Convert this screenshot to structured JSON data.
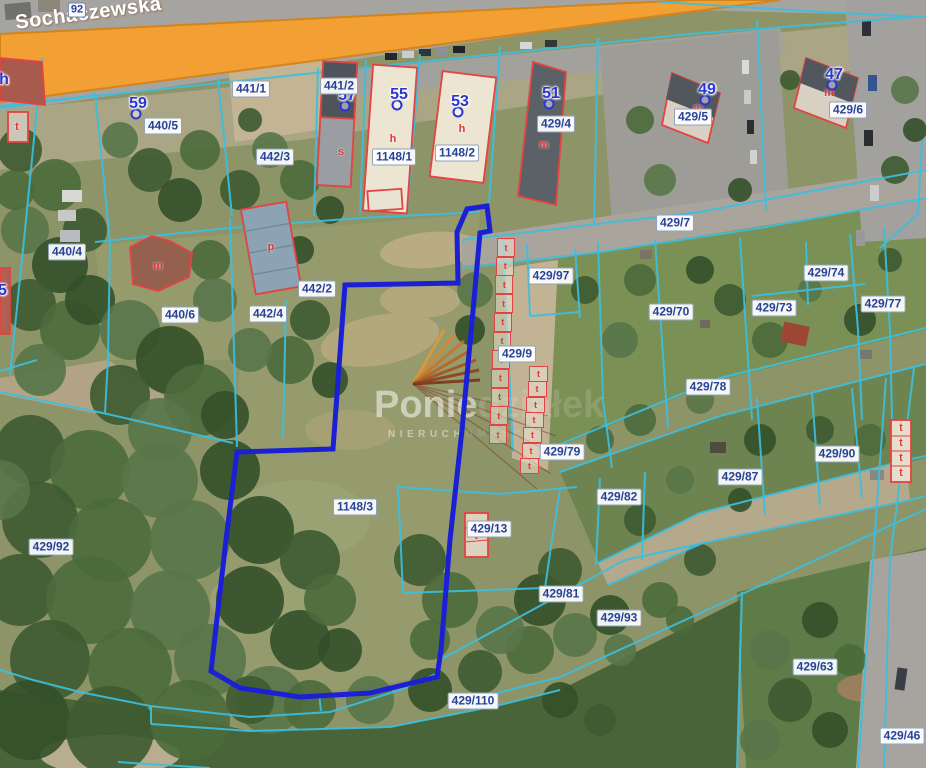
{
  "map": {
    "street": {
      "name": "Sochaczewska",
      "road_number": "92"
    },
    "watermark": {
      "brand_strong": "Ponie",
      "brand_faint": "działek",
      "subtitle_strong": "NIERUCH",
      "subtitle_faint": "OMOŚCI"
    },
    "colors": {
      "parcel_line": "#3dbfdf",
      "selected_parcel": "#1c20d4",
      "building_outline": "#e34343",
      "label_text": "#26429a",
      "house_number": "#2b36cf",
      "letter_red": "#e23535",
      "road_orange": "#f2a033",
      "road_border": "#d3841c"
    },
    "parcel_labels": [
      {
        "text": "440/5",
        "x": 163,
        "y": 126
      },
      {
        "text": "441/1",
        "x": 251,
        "y": 89
      },
      {
        "text": "441/2",
        "x": 339,
        "y": 86
      },
      {
        "text": "442/3",
        "x": 275,
        "y": 157
      },
      {
        "text": "1148/1",
        "x": 394,
        "y": 157
      },
      {
        "text": "1148/2",
        "x": 457,
        "y": 153
      },
      {
        "text": "429/4",
        "x": 556,
        "y": 124
      },
      {
        "text": "429/5",
        "x": 693,
        "y": 117
      },
      {
        "text": "429/6",
        "x": 848,
        "y": 110
      },
      {
        "text": "429/7",
        "x": 675,
        "y": 223
      },
      {
        "text": "440/4",
        "x": 67,
        "y": 252
      },
      {
        "text": "442/2",
        "x": 317,
        "y": 289
      },
      {
        "text": "440/6",
        "x": 180,
        "y": 315
      },
      {
        "text": "442/4",
        "x": 268,
        "y": 314
      },
      {
        "text": "429/97",
        "x": 551,
        "y": 276
      },
      {
        "text": "429/70",
        "x": 671,
        "y": 312
      },
      {
        "text": "429/74",
        "x": 826,
        "y": 273
      },
      {
        "text": "429/73",
        "x": 774,
        "y": 308
      },
      {
        "text": "429/77",
        "x": 883,
        "y": 304
      },
      {
        "text": "429/9",
        "x": 517,
        "y": 354
      },
      {
        "text": "429/78",
        "x": 708,
        "y": 387
      },
      {
        "text": "429/79",
        "x": 562,
        "y": 452
      },
      {
        "text": "429/90",
        "x": 837,
        "y": 454
      },
      {
        "text": "429/87",
        "x": 740,
        "y": 477
      },
      {
        "text": "429/82",
        "x": 619,
        "y": 497
      },
      {
        "text": "1148/3",
        "x": 355,
        "y": 507
      },
      {
        "text": "429/13",
        "x": 489,
        "y": 529
      },
      {
        "text": "429/92",
        "x": 51,
        "y": 547
      },
      {
        "text": "429/81",
        "x": 561,
        "y": 594
      },
      {
        "text": "429/93",
        "x": 619,
        "y": 618
      },
      {
        "text": "429/63",
        "x": 815,
        "y": 667
      },
      {
        "text": "429/110",
        "x": 473,
        "y": 701
      },
      {
        "text": "429/46",
        "x": 902,
        "y": 736
      }
    ],
    "house_numbers": [
      {
        "text": "59",
        "x": 138,
        "y": 104,
        "marker": true
      },
      {
        "text": "57",
        "x": 347,
        "y": 96,
        "marker": true
      },
      {
        "text": "55",
        "x": 399,
        "y": 95,
        "marker": true
      },
      {
        "text": "53",
        "x": 460,
        "y": 102,
        "marker": true
      },
      {
        "text": "51",
        "x": 551,
        "y": 94,
        "marker": true
      },
      {
        "text": "49",
        "x": 707,
        "y": 90,
        "marker": true
      },
      {
        "text": "47",
        "x": 834,
        "y": 75,
        "marker": true
      },
      {
        "text": "35",
        "x": -2,
        "y": 291,
        "marker": false
      },
      {
        "text": "h",
        "x": 4,
        "y": 80,
        "marker": false
      }
    ],
    "building_letters": [
      {
        "text": "s",
        "x": 341,
        "y": 152
      },
      {
        "text": "h",
        "x": 393,
        "y": 139
      },
      {
        "text": "h",
        "x": 462,
        "y": 129
      },
      {
        "text": "m",
        "x": 544,
        "y": 145
      },
      {
        "text": "m",
        "x": 698,
        "y": 108
      },
      {
        "text": "m",
        "x": 829,
        "y": 93
      },
      {
        "text": "m",
        "x": 158,
        "y": 266
      },
      {
        "text": "p",
        "x": 271,
        "y": 247
      },
      {
        "text": "t",
        "x": 17,
        "y": 127
      },
      {
        "text": "t",
        "x": 476,
        "y": 536
      },
      {
        "text": "t",
        "x": 901,
        "y": 428
      },
      {
        "text": "t",
        "x": 901,
        "y": 443
      },
      {
        "text": "t",
        "x": 901,
        "y": 458
      },
      {
        "text": "t",
        "x": 901,
        "y": 473
      }
    ],
    "garage_letter": "t",
    "garage_rows": [
      {
        "x": 497,
        "y": 238,
        "w": 16,
        "h": 17,
        "count": 11,
        "dx": -0.8,
        "dy": 18.7
      },
      {
        "x": 529,
        "y": 366,
        "w": 17,
        "h": 14,
        "count": 7,
        "dx": -1.5,
        "dy": 15.3
      }
    ]
  }
}
